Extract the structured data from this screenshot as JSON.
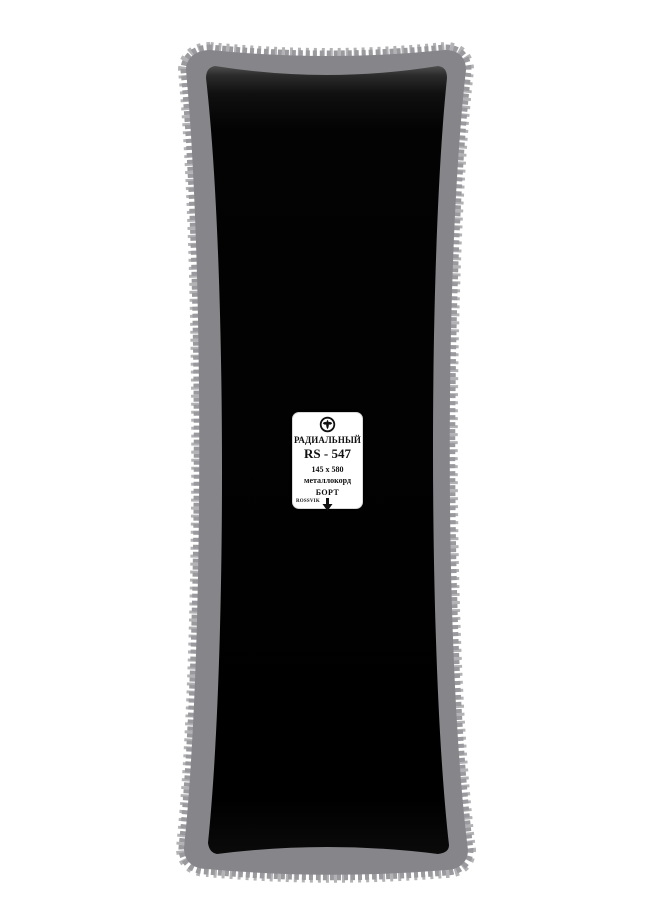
{
  "product": {
    "type_label": "РАДИАЛЬНЫЙ",
    "model": "RS - 547",
    "size": "145 x 580",
    "cord": "металлокорд",
    "bead_label": "БОРТ",
    "brand": "ROSSVIK"
  },
  "icons": {
    "logo": "rossvik-logo",
    "arrow": "down-arrow"
  },
  "colors": {
    "backing_gray": "#85858a",
    "fringe_light": "#b3b3b6",
    "fringe_mid": "#9a9a9e",
    "patch_black": "#050505",
    "label_bg": "#ffffff",
    "ink": "#111111"
  }
}
